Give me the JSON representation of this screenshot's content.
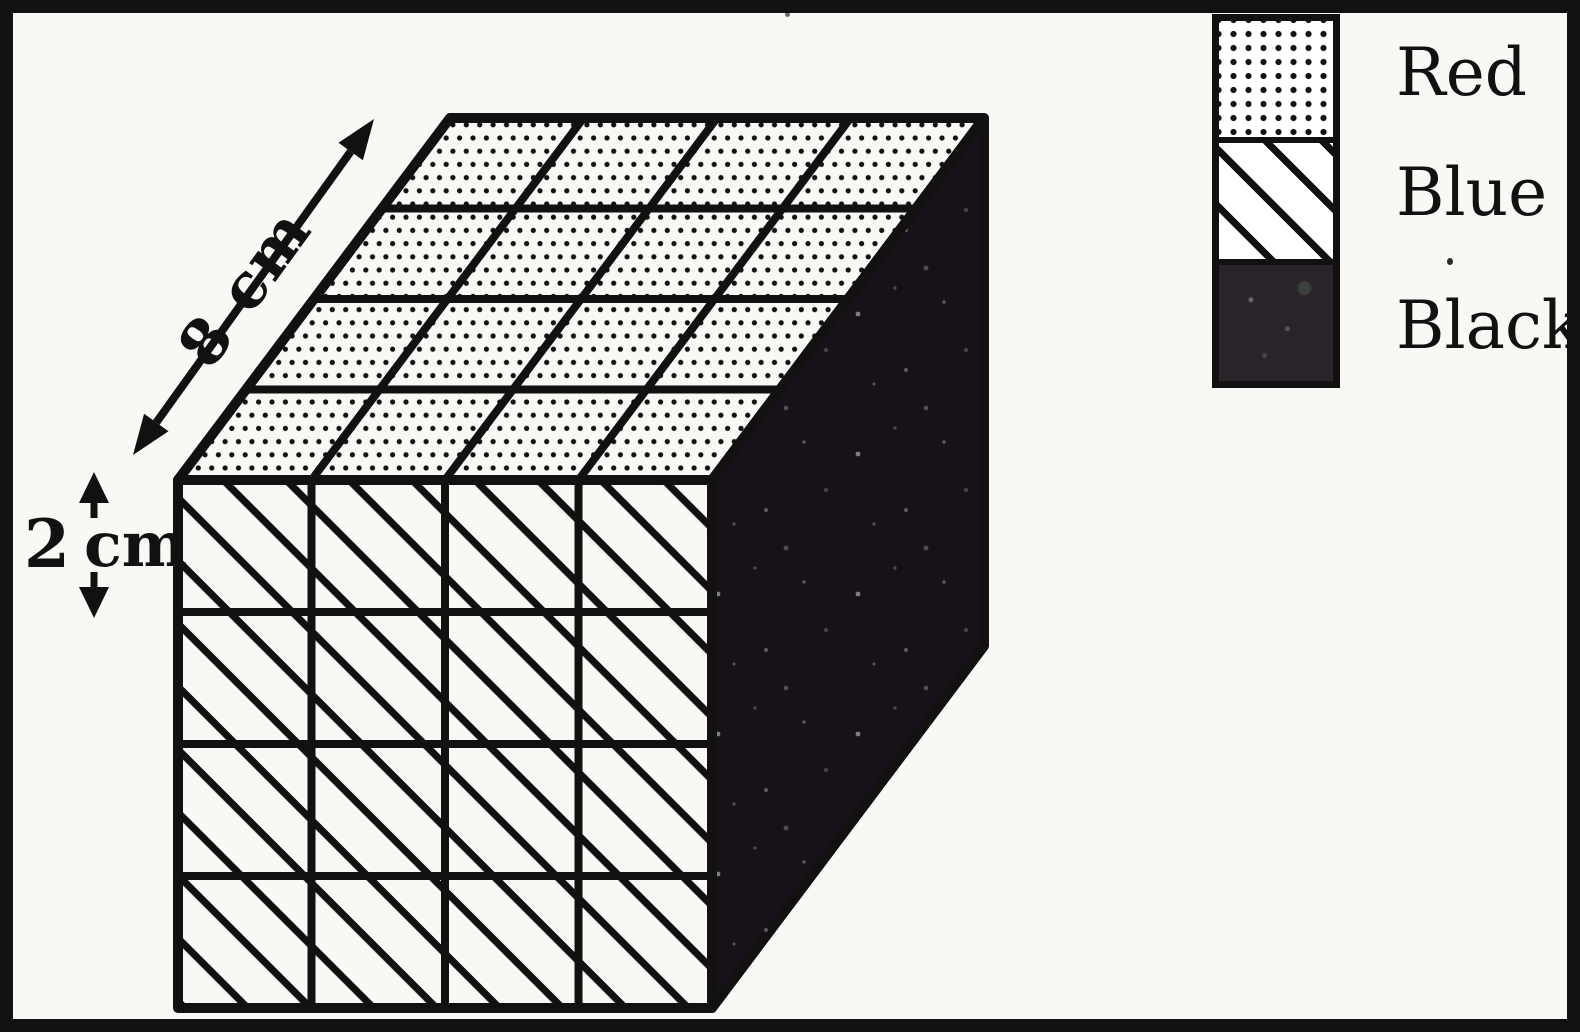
{
  "figure": {
    "depth_label": "8 cm",
    "height_value": "2",
    "height_unit": "cm",
    "cube": {
      "top_face": {
        "color_name": "Red",
        "pattern": "dots",
        "rows": 4,
        "cols": 4
      },
      "front_face": {
        "color_name": "Blue",
        "pattern": "diagonal-hatch",
        "rows": 4,
        "cols": 4
      },
      "right_face": {
        "color_name": "Black",
        "pattern": "solid-black"
      }
    }
  },
  "legend": {
    "items": [
      {
        "label": "Red",
        "pattern": "dots"
      },
      {
        "label": "Blue",
        "pattern": "diagonal-hatch"
      },
      {
        "label": "Black",
        "pattern": "solid-black"
      }
    ]
  },
  "colors": {
    "paper": "#faf8f5",
    "ink": "#121010",
    "side_face": "#17121a",
    "legend_black": "#2a232a"
  }
}
